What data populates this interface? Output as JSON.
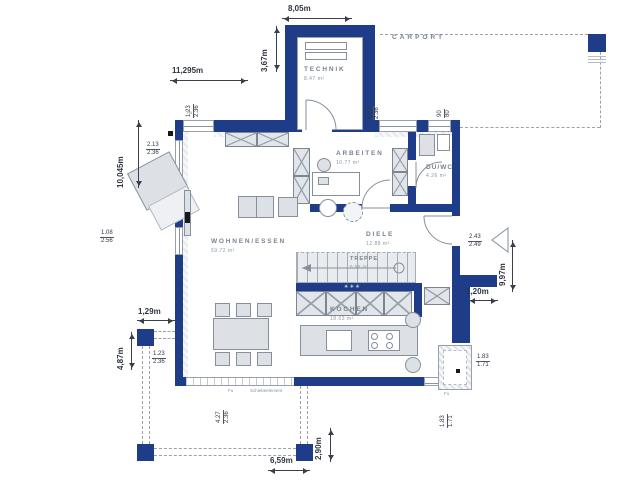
{
  "palette": {
    "wall_color": "#1e3c88",
    "fixture_fill": "#dde1e6",
    "fixture_line": "#868f9b",
    "dashed_line": "#9aa2ac",
    "room_label": "#79838f",
    "dimension_text": "#2f3540",
    "background": "#ffffff"
  },
  "rooms": {
    "technik": {
      "name": "TECHNIK",
      "area": "8.47 m²"
    },
    "carport": {
      "name": "CARPORT"
    },
    "wohnen_essen": {
      "name": "WOHNEN/ESSEN",
      "area": "59.72 m²"
    },
    "arbeiten": {
      "name": "ARBEITEN",
      "area": "10.77 m²"
    },
    "du_wc": {
      "name": "DU/WC",
      "area": "4.26 m²"
    },
    "diele": {
      "name": "DIELE",
      "area": "12.88 m²"
    },
    "treppe": {
      "name": "TREPPE",
      "area": "5.06 m²"
    },
    "kochen": {
      "name": "KOCHEN",
      "area": "18.03 m²"
    }
  },
  "dims": {
    "technik_width": "8,05m",
    "technik_depth": "3,67m",
    "house_width": "11,295m",
    "house_depth": "10,045m",
    "right_depth": "9,97m",
    "entry_offset": "1,20m",
    "terrace_offset": "1,29m",
    "terrace_depth": "4,87m",
    "terrace_width": "6,59m",
    "patio_depth": "2,90m"
  },
  "windows": {
    "top_left": {
      "top": "1.23",
      "bottom": "2.36"
    },
    "technik_right": {
      "top": "1.52",
      "bottom": "2.36"
    },
    "top_right_small": {
      "top": "90",
      "bottom": "80"
    },
    "left_upper": {
      "top": "2.13",
      "bottom": "2.36"
    },
    "left_lower": {
      "top": "1.08",
      "bottom": "2.56"
    },
    "entry": {
      "top": "2.43",
      "bottom": "2.49"
    },
    "patio_right": {
      "top": "1.83",
      "bottom": "1.71"
    },
    "patio_bottom": {
      "top": "1.83",
      "bottom": "1.71"
    },
    "terrace_corner": {
      "top": "1.23",
      "bottom": "2.36"
    },
    "sliding": {
      "top": "4.27",
      "bottom": "2.36"
    }
  },
  "annotations": {
    "sliding_element": "Schiebeelement",
    "floor_marker_1": "Fu",
    "floor_marker_2": "Fu",
    "floor_marker_3": "Fu",
    "stair_symbols": "✳✳✳"
  }
}
